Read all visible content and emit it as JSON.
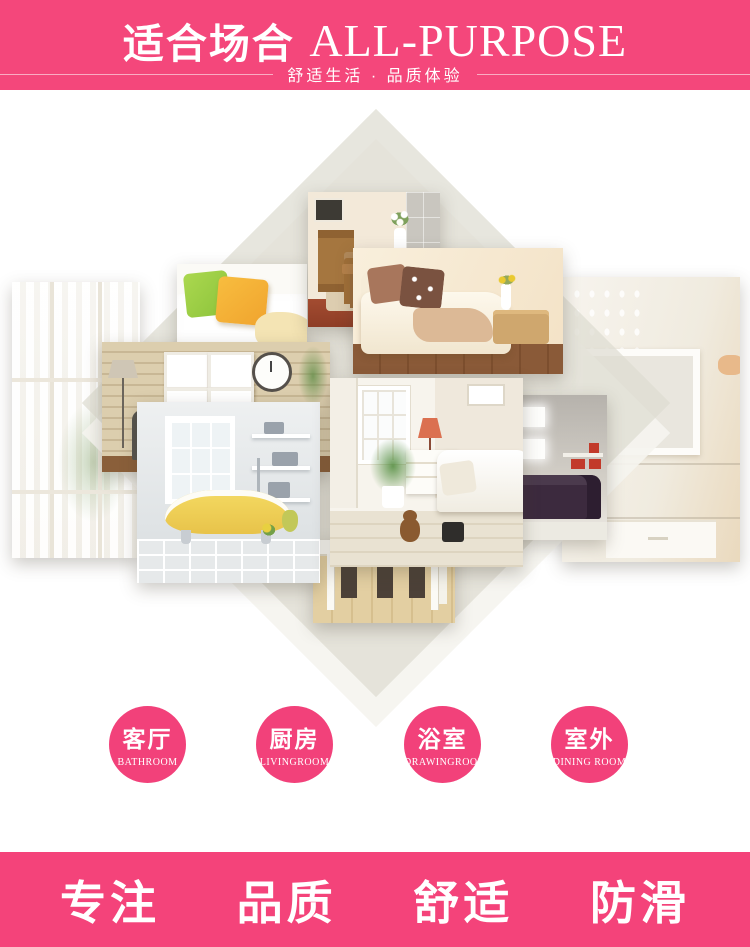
{
  "header": {
    "title_cn": "适合场合",
    "title_en": "ALL-PURPOSE",
    "subtitle": "舒适生活 · 品质体验"
  },
  "collage": {
    "photos": [
      {
        "id": "window-left",
        "label": "bright window with sheer curtains"
      },
      {
        "id": "pillows-sofa",
        "label": "white sofa with green and yellow pillows"
      },
      {
        "id": "wood-dining",
        "label": "wooden dining room with cabinet and flower vase"
      },
      {
        "id": "cream-chaise",
        "label": "cream chaise sofa with brown pillows and throw"
      },
      {
        "id": "brick-wall",
        "label": "brick wall with mirror frames, clock and armchair"
      },
      {
        "id": "bathroom-tub",
        "label": "bathroom with yellow clawfoot bathtub"
      },
      {
        "id": "living-room",
        "label": "living room with white sofa, lamp and palm plant"
      },
      {
        "id": "dining-table",
        "label": "white dining table with chairs on wood floor"
      },
      {
        "id": "dark-sofa",
        "label": "dark leather sofa with glowing wall frames"
      },
      {
        "id": "wall-panel",
        "label": "bright wall with white frame panel and cabinet"
      }
    ]
  },
  "badges": [
    {
      "cn": "客厅",
      "en": "BATHROOM"
    },
    {
      "cn": "厨房",
      "en": "LIVINGROOM"
    },
    {
      "cn": "浴室",
      "en": "DRAWINGROOM"
    },
    {
      "cn": "室外",
      "en": "DINING ROOM"
    }
  ],
  "footer": {
    "items": [
      "专注",
      "品质",
      "舒适",
      "防滑"
    ]
  },
  "colors": {
    "banner_pink": "#f4477b",
    "badge_pink": "#f2417a",
    "footer_pink": "#f4437a",
    "diamond_gray": "#eae8df"
  }
}
